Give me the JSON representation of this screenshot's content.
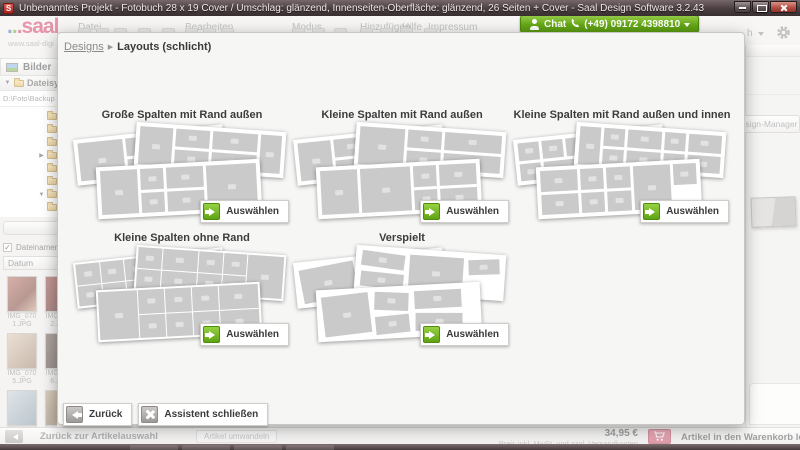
{
  "window": {
    "title": "Unbenanntes Projekt - Fotobuch 28 x 19 Cover / Umschlag: glänzend, Innenseiten-Oberfläche: glänzend, 26 Seiten + Cover - Saal Design Software 3.2.43"
  },
  "header": {
    "logo_dots": "...",
    "logo_text": "saal",
    "logo_tagline": "www.saal-digi",
    "menus": [
      "Datei",
      "Bearbeiten",
      "Modus",
      "Hinzufügen",
      "Hilfe",
      "Impressum"
    ],
    "chat": {
      "label": "Chat",
      "phone": "(+49) 09172 4398810"
    },
    "language_partial": "h"
  },
  "sidebar": {
    "panel_title": "Bilder",
    "tree_header": "Dateisystem",
    "path": "D:\\Foto\\Backup",
    "folder_rows": [
      "none",
      "none",
      "none",
      "expand",
      "none",
      "none",
      "collapse",
      "none"
    ],
    "show_filenames_label": "Dateinamen zeigen",
    "check_glyph": "✓",
    "sort_label": "Datum",
    "photos": [
      {
        "name": "IMG_0701.JPG"
      },
      {
        "name": "IMG_0702.JPG"
      },
      {
        "name": "IMG_0705.JPG"
      },
      {
        "name": "IMG_0706.JPG"
      },
      {
        "name": ""
      },
      {
        "name": ""
      }
    ],
    "auto_label": "Automatisch"
  },
  "right_panel": {
    "design_manager_label": "Design-Manager"
  },
  "modal": {
    "breadcrumb": {
      "parent": "Designs",
      "separator": "▶",
      "current": "Layouts (schlicht)"
    },
    "options": [
      {
        "title": "Große Spalten mit Rand außen",
        "button": "Auswählen",
        "pattern": "big"
      },
      {
        "title": "Kleine Spalten mit Rand außen",
        "button": "Auswählen",
        "pattern": "medium"
      },
      {
        "title": "Kleine Spalten mit Rand außen und innen",
        "button": "Auswählen",
        "pattern": "small"
      },
      {
        "title": "Kleine Spalten ohne Rand",
        "button": "Auswählen",
        "pattern": "dense"
      },
      {
        "title": "Verspielt",
        "button": "Auswählen",
        "pattern": "playful"
      }
    ],
    "footer": {
      "back": "Zurück",
      "close": "Assistent schließen"
    }
  },
  "bottombar": {
    "back_label": "Zurück zur Artikelauswahl",
    "convert_label": "Artikel umwandeln",
    "price": "34,95 €",
    "price_note": "Preis inkl. MwSt. und zzgl. Versandkosten",
    "cart_label": "Artikel in den Warenkorb legen"
  },
  "colors": {
    "accent_green": "#76b82a",
    "brand_red": "#d2375f",
    "cart_pink": "#d9566e",
    "titlebar_brown": "#4a3e40"
  }
}
